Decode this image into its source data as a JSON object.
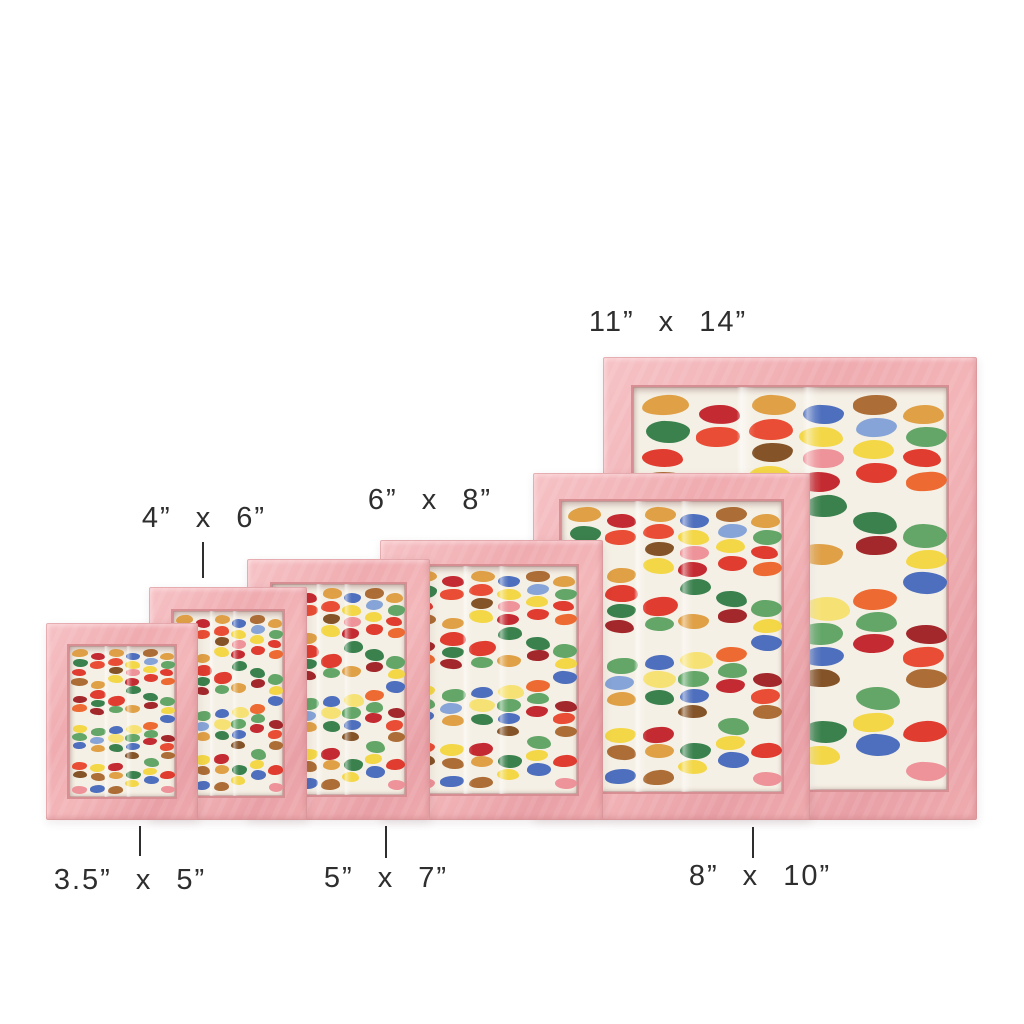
{
  "colors": {
    "background": "#ffffff",
    "label_text": "#2e2e2e",
    "frame_pink": "#efabaf",
    "frame_pink_light": "#f6c3c6",
    "frame_pink_dark": "#d88f94",
    "paper": "#f5f0e5"
  },
  "frames": [
    {
      "id": "3.5x5",
      "size_label": "3.5” x 5”"
    },
    {
      "id": "4x6",
      "size_label": "4” x 6”"
    },
    {
      "id": "5x7",
      "size_label": "5” x 7”"
    },
    {
      "id": "6x8",
      "size_label": "6” x 8”"
    },
    {
      "id": "8x10",
      "size_label": "8” x 10”"
    },
    {
      "id": "11x14",
      "size_label": "11” x 14”"
    }
  ],
  "artwork": {
    "description": "watercolor dash swatches in loose vertical columns on white paper",
    "palette": {
      "red": "#de3226",
      "red2": "#c11f27",
      "maroon": "#9e1c22",
      "orange": "#ec6329",
      "tangerine": "#e8432b",
      "amber": "#dd9b3d",
      "brown": "#a8652c",
      "darkbrown": "#7d4a1e",
      "yellow": "#f2d53e",
      "paleyellow": "#f5e06e",
      "green": "#5ba161",
      "darkgreen": "#2f7a44",
      "blue": "#4467bb",
      "ltblue": "#7f9fd6",
      "rose": "#ec8d95"
    },
    "blobs": [
      {
        "x": 0.03,
        "y": 0.02,
        "w": 0.15,
        "h": 0.05,
        "c": "amber"
      },
      {
        "x": 0.04,
        "y": 0.085,
        "w": 0.14,
        "h": 0.055,
        "c": "darkgreen"
      },
      {
        "x": 0.03,
        "y": 0.155,
        "w": 0.13,
        "h": 0.045,
        "c": "red"
      },
      {
        "x": 0.02,
        "y": 0.21,
        "w": 0.16,
        "h": 0.05,
        "c": "brown"
      },
      {
        "x": 0.04,
        "y": 0.33,
        "w": 0.13,
        "h": 0.048,
        "c": "maroon"
      },
      {
        "x": 0.03,
        "y": 0.385,
        "w": 0.14,
        "h": 0.05,
        "c": "orange"
      },
      {
        "x": 0.04,
        "y": 0.52,
        "w": 0.13,
        "h": 0.05,
        "c": "yellow"
      },
      {
        "x": 0.03,
        "y": 0.578,
        "w": 0.14,
        "h": 0.052,
        "c": "green"
      },
      {
        "x": 0.04,
        "y": 0.635,
        "w": 0.12,
        "h": 0.045,
        "c": "blue"
      },
      {
        "x": 0.03,
        "y": 0.77,
        "w": 0.14,
        "h": 0.05,
        "c": "tangerine"
      },
      {
        "x": 0.04,
        "y": 0.828,
        "w": 0.13,
        "h": 0.048,
        "c": "darkbrown"
      },
      {
        "x": 0.03,
        "y": 0.93,
        "w": 0.14,
        "h": 0.05,
        "c": "rose"
      },
      {
        "x": 0.21,
        "y": 0.045,
        "w": 0.13,
        "h": 0.048,
        "c": "red2"
      },
      {
        "x": 0.2,
        "y": 0.1,
        "w": 0.14,
        "h": 0.05,
        "c": "tangerine"
      },
      {
        "x": 0.21,
        "y": 0.23,
        "w": 0.13,
        "h": 0.05,
        "c": "amber"
      },
      {
        "x": 0.2,
        "y": 0.29,
        "w": 0.15,
        "h": 0.06,
        "c": "red"
      },
      {
        "x": 0.21,
        "y": 0.355,
        "w": 0.13,
        "h": 0.048,
        "c": "darkgreen"
      },
      {
        "x": 0.2,
        "y": 0.41,
        "w": 0.13,
        "h": 0.045,
        "c": "maroon"
      },
      {
        "x": 0.21,
        "y": 0.54,
        "w": 0.14,
        "h": 0.055,
        "c": "green"
      },
      {
        "x": 0.2,
        "y": 0.6,
        "w": 0.13,
        "h": 0.048,
        "c": "ltblue"
      },
      {
        "x": 0.21,
        "y": 0.655,
        "w": 0.13,
        "h": 0.048,
        "c": "amber"
      },
      {
        "x": 0.2,
        "y": 0.78,
        "w": 0.14,
        "h": 0.052,
        "c": "yellow"
      },
      {
        "x": 0.21,
        "y": 0.84,
        "w": 0.13,
        "h": 0.05,
        "c": "brown"
      },
      {
        "x": 0.2,
        "y": 0.92,
        "w": 0.14,
        "h": 0.05,
        "c": "blue"
      },
      {
        "x": 0.38,
        "y": 0.02,
        "w": 0.14,
        "h": 0.05,
        "c": "amber"
      },
      {
        "x": 0.37,
        "y": 0.08,
        "w": 0.14,
        "h": 0.052,
        "c": "tangerine"
      },
      {
        "x": 0.38,
        "y": 0.14,
        "w": 0.13,
        "h": 0.048,
        "c": "darkbrown"
      },
      {
        "x": 0.37,
        "y": 0.195,
        "w": 0.14,
        "h": 0.055,
        "c": "yellow"
      },
      {
        "x": 0.37,
        "y": 0.33,
        "w": 0.16,
        "h": 0.065,
        "c": "red"
      },
      {
        "x": 0.38,
        "y": 0.4,
        "w": 0.13,
        "h": 0.048,
        "c": "green"
      },
      {
        "x": 0.38,
        "y": 0.53,
        "w": 0.13,
        "h": 0.05,
        "c": "blue"
      },
      {
        "x": 0.37,
        "y": 0.585,
        "w": 0.15,
        "h": 0.058,
        "c": "paleyellow"
      },
      {
        "x": 0.38,
        "y": 0.65,
        "w": 0.13,
        "h": 0.05,
        "c": "darkgreen"
      },
      {
        "x": 0.37,
        "y": 0.775,
        "w": 0.14,
        "h": 0.055,
        "c": "red2"
      },
      {
        "x": 0.38,
        "y": 0.835,
        "w": 0.13,
        "h": 0.048,
        "c": "amber"
      },
      {
        "x": 0.37,
        "y": 0.925,
        "w": 0.14,
        "h": 0.05,
        "c": "brown"
      },
      {
        "x": 0.54,
        "y": 0.045,
        "w": 0.13,
        "h": 0.048,
        "c": "blue"
      },
      {
        "x": 0.53,
        "y": 0.1,
        "w": 0.14,
        "h": 0.05,
        "c": "yellow"
      },
      {
        "x": 0.54,
        "y": 0.155,
        "w": 0.13,
        "h": 0.048,
        "c": "rose"
      },
      {
        "x": 0.53,
        "y": 0.21,
        "w": 0.13,
        "h": 0.05,
        "c": "red2"
      },
      {
        "x": 0.54,
        "y": 0.268,
        "w": 0.14,
        "h": 0.055,
        "c": "darkgreen"
      },
      {
        "x": 0.53,
        "y": 0.39,
        "w": 0.14,
        "h": 0.052,
        "c": "amber"
      },
      {
        "x": 0.54,
        "y": 0.52,
        "w": 0.15,
        "h": 0.06,
        "c": "paleyellow"
      },
      {
        "x": 0.53,
        "y": 0.585,
        "w": 0.14,
        "h": 0.055,
        "c": "green"
      },
      {
        "x": 0.54,
        "y": 0.645,
        "w": 0.13,
        "h": 0.048,
        "c": "blue"
      },
      {
        "x": 0.53,
        "y": 0.7,
        "w": 0.13,
        "h": 0.045,
        "c": "darkbrown"
      },
      {
        "x": 0.54,
        "y": 0.83,
        "w": 0.14,
        "h": 0.055,
        "c": "darkgreen"
      },
      {
        "x": 0.53,
        "y": 0.89,
        "w": 0.13,
        "h": 0.048,
        "c": "yellow"
      },
      {
        "x": 0.7,
        "y": 0.02,
        "w": 0.14,
        "h": 0.05,
        "c": "brown"
      },
      {
        "x": 0.71,
        "y": 0.078,
        "w": 0.13,
        "h": 0.048,
        "c": "ltblue"
      },
      {
        "x": 0.7,
        "y": 0.132,
        "w": 0.13,
        "h": 0.048,
        "c": "yellow"
      },
      {
        "x": 0.71,
        "y": 0.188,
        "w": 0.13,
        "h": 0.05,
        "c": "red"
      },
      {
        "x": 0.7,
        "y": 0.31,
        "w": 0.14,
        "h": 0.055,
        "c": "darkgreen"
      },
      {
        "x": 0.71,
        "y": 0.37,
        "w": 0.13,
        "h": 0.048,
        "c": "maroon"
      },
      {
        "x": 0.7,
        "y": 0.5,
        "w": 0.14,
        "h": 0.052,
        "c": "orange"
      },
      {
        "x": 0.71,
        "y": 0.558,
        "w": 0.13,
        "h": 0.05,
        "c": "green"
      },
      {
        "x": 0.7,
        "y": 0.612,
        "w": 0.13,
        "h": 0.048,
        "c": "red2"
      },
      {
        "x": 0.71,
        "y": 0.745,
        "w": 0.14,
        "h": 0.058,
        "c": "green"
      },
      {
        "x": 0.7,
        "y": 0.808,
        "w": 0.13,
        "h": 0.048,
        "c": "yellow"
      },
      {
        "x": 0.71,
        "y": 0.862,
        "w": 0.14,
        "h": 0.055,
        "c": "blue"
      },
      {
        "x": 0.86,
        "y": 0.045,
        "w": 0.13,
        "h": 0.048,
        "c": "amber"
      },
      {
        "x": 0.87,
        "y": 0.1,
        "w": 0.13,
        "h": 0.05,
        "c": "green"
      },
      {
        "x": 0.86,
        "y": 0.155,
        "w": 0.12,
        "h": 0.045,
        "c": "red"
      },
      {
        "x": 0.87,
        "y": 0.21,
        "w": 0.13,
        "h": 0.048,
        "c": "orange"
      },
      {
        "x": 0.86,
        "y": 0.34,
        "w": 0.14,
        "h": 0.06,
        "c": "green"
      },
      {
        "x": 0.87,
        "y": 0.405,
        "w": 0.13,
        "h": 0.048,
        "c": "yellow"
      },
      {
        "x": 0.86,
        "y": 0.46,
        "w": 0.14,
        "h": 0.055,
        "c": "blue"
      },
      {
        "x": 0.87,
        "y": 0.59,
        "w": 0.13,
        "h": 0.048,
        "c": "maroon"
      },
      {
        "x": 0.86,
        "y": 0.645,
        "w": 0.13,
        "h": 0.05,
        "c": "tangerine"
      },
      {
        "x": 0.87,
        "y": 0.7,
        "w": 0.13,
        "h": 0.048,
        "c": "brown"
      },
      {
        "x": 0.86,
        "y": 0.83,
        "w": 0.14,
        "h": 0.052,
        "c": "red"
      },
      {
        "x": 0.87,
        "y": 0.93,
        "w": 0.13,
        "h": 0.048,
        "c": "rose"
      }
    ]
  }
}
